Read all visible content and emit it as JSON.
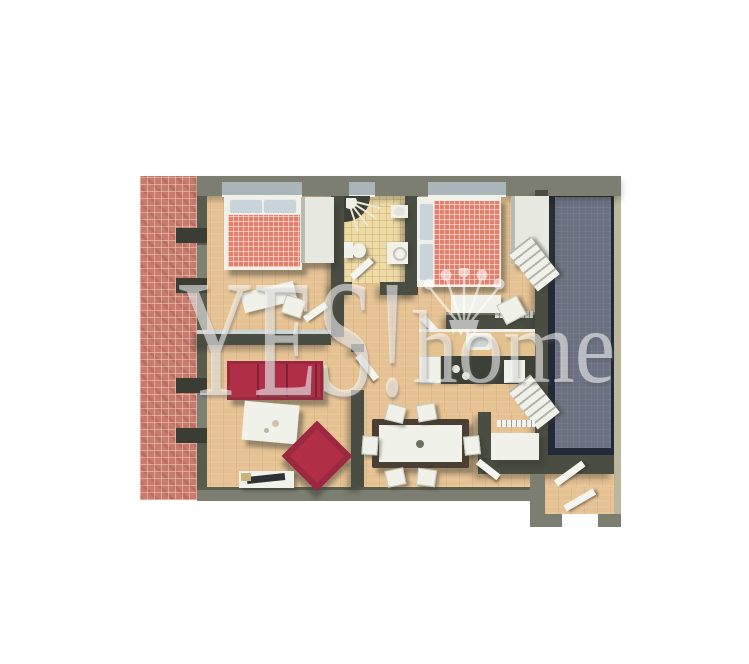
{
  "watermark": {
    "brand": "YES!",
    "suffix": "home",
    "crown_icon": "crown-icon",
    "color": "#ffffff"
  },
  "palette": {
    "background": "#ffffff",
    "outer_wall": "#7b7e70",
    "inner_wall": "#4a4d42",
    "glass_top": "#ccd5d3",
    "wood_floor": "#e6c293",
    "tile_floor": "#eedba8",
    "brick": "#c67b6d",
    "terrace": "#6b7180",
    "terrace_frame": "#232938",
    "outer_edge": "#bcb79c",
    "window_glass": "#a9b5b9",
    "furniture_white": "#f0f1e9",
    "sofa_red": "#b12e47",
    "bed_red": "#e0806d",
    "pillow_blue": "#c9d4da",
    "counter_dark": "#3c4037",
    "shadow": "rgba(56,58,48,0.45)"
  }
}
